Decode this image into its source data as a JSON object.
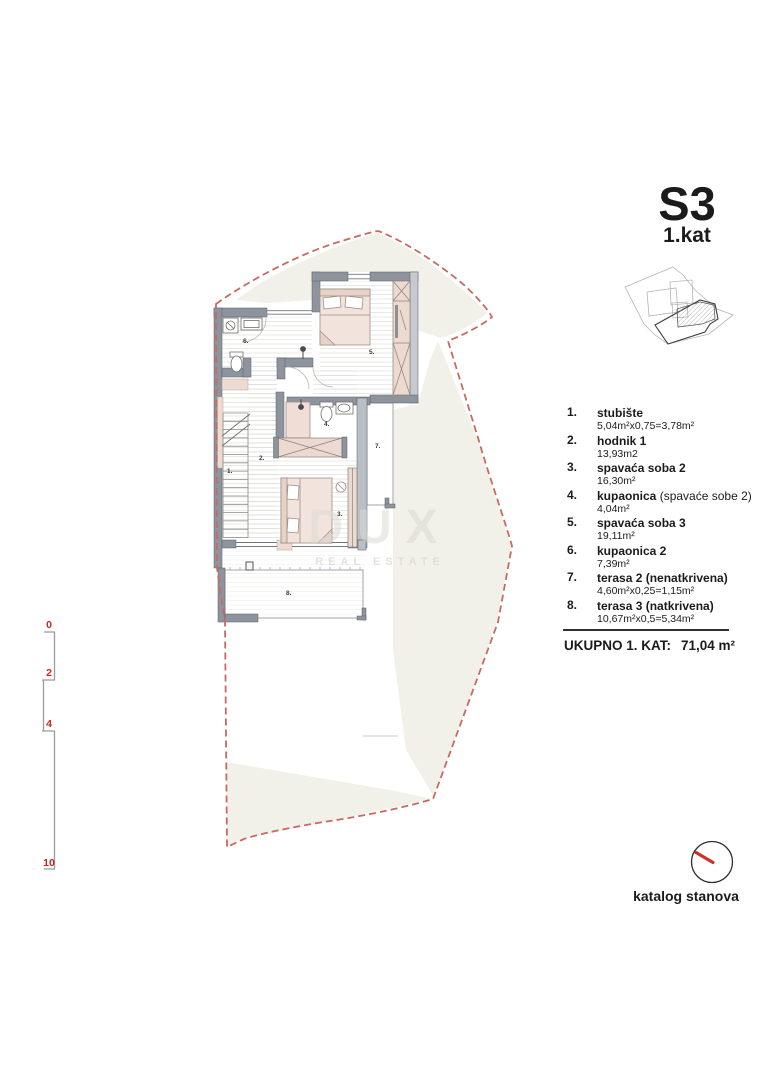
{
  "title": {
    "code": "S3",
    "floor": "1.kat"
  },
  "legend": {
    "items": [
      {
        "number": "1.",
        "name": "stubište",
        "name_suffix": "",
        "area": "5,04m²x0,75=3,78m²"
      },
      {
        "number": "2.",
        "name": "hodnik 1",
        "name_suffix": "",
        "area": "13,93m2"
      },
      {
        "number": "3.",
        "name": "spavaća soba 2",
        "name_suffix": "",
        "area": "16,30m²"
      },
      {
        "number": "4.",
        "name": "kupaonica",
        "name_suffix": " (spavaće sobe 2)",
        "area": "4,04m²"
      },
      {
        "number": "5.",
        "name": "spavaća soba 3",
        "name_suffix": "",
        "area": "19,11m²"
      },
      {
        "number": "6.",
        "name": "kupaonica 2",
        "name_suffix": "",
        "area": "7,39m²"
      },
      {
        "number": "7.",
        "name": "terasa 2 (nenatkrivena)",
        "name_suffix": "",
        "area": "4,60m²x0,25=1,15m²"
      },
      {
        "number": "8.",
        "name": "terasa 3 (natkrivena)",
        "name_suffix": "",
        "area": "10,67m²x0,5=5,34m²"
      }
    ]
  },
  "total": {
    "label": "UKUPNO 1. KAT:",
    "value": "71,04 m²"
  },
  "plan": {
    "room_labels": [
      "1.",
      "2.",
      "3.",
      "4.",
      "5.",
      "6.",
      "7.",
      "8."
    ]
  },
  "scale_bar": {
    "marks": [
      "0",
      "2",
      "4",
      "10"
    ]
  },
  "watermark": {
    "line1": "DUX",
    "line2": "REAL ESTATE"
  },
  "footer": {
    "caption": "katalog stanova"
  },
  "colors": {
    "boundary_red": "#c96a60",
    "scale_red": "#cc241a",
    "needle_red": "#cd3127",
    "wall_gray": "#8e949d",
    "furniture_pink": "#ecd9d0",
    "background_beige": "#f1f1ea"
  }
}
